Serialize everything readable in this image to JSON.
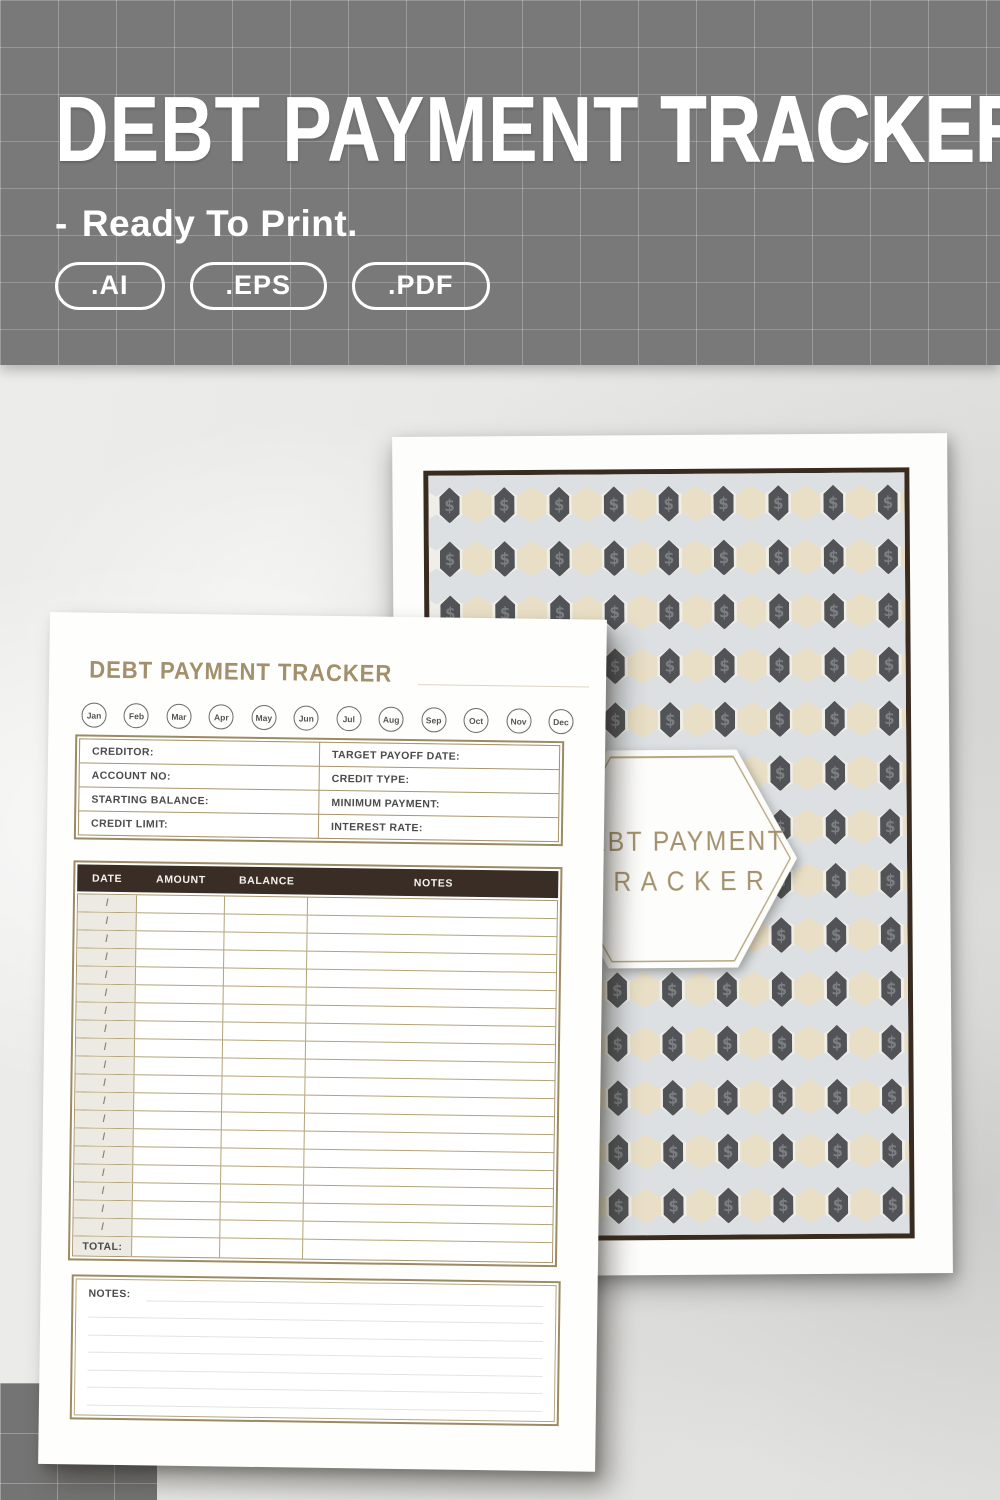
{
  "banner": {
    "title_regular": "DEBT PAYMENT",
    "title_bold": "TRACKER",
    "dash": "-",
    "subtitle": "Ready To Print.",
    "badges": [
      ".AI",
      ".EPS",
      ".PDF"
    ]
  },
  "tracker_page": {
    "title": "DEBT PAYMENT TRACKER",
    "months": [
      "Jan",
      "Feb",
      "Mar",
      "Apr",
      "May",
      "Jun",
      "Jul",
      "Aug",
      "Sep",
      "Oct",
      "Nov",
      "Dec"
    ],
    "info_fields": [
      {
        "left": "CREDITOR:",
        "right": "TARGET PAYOFF DATE:"
      },
      {
        "left": "ACCOUNT NO:",
        "right": "CREDIT TYPE:"
      },
      {
        "left": "STARTING BALANCE:",
        "right": "MINIMUM PAYMENT:"
      },
      {
        "left": "CREDIT LIMIT:",
        "right": "INTEREST RATE:"
      }
    ],
    "table": {
      "headers": [
        "DATE",
        "AMOUNT",
        "BALANCE",
        "NOTES"
      ],
      "row_count": 19,
      "date_cell_glyph": "/",
      "total_label": "TOTAL:"
    },
    "notes_label": "NOTES:",
    "notes_line_count": 7
  },
  "cover_page": {
    "title_line1": "DEBT PAYMENT",
    "title_line2": "TRACKER",
    "dollar_glyph": "$",
    "hex_colors": {
      "dark": "#515356",
      "beige": "#e9dfc6",
      "gray": "#dce0e3"
    }
  },
  "colors": {
    "banner_bg": "#797979",
    "gold_border": "#9c8a63",
    "tan_title": "#a28f6b",
    "dark_brown": "#3a2d25",
    "date_cell_bg": "#edeae3",
    "badge_text": "#a4916c"
  }
}
